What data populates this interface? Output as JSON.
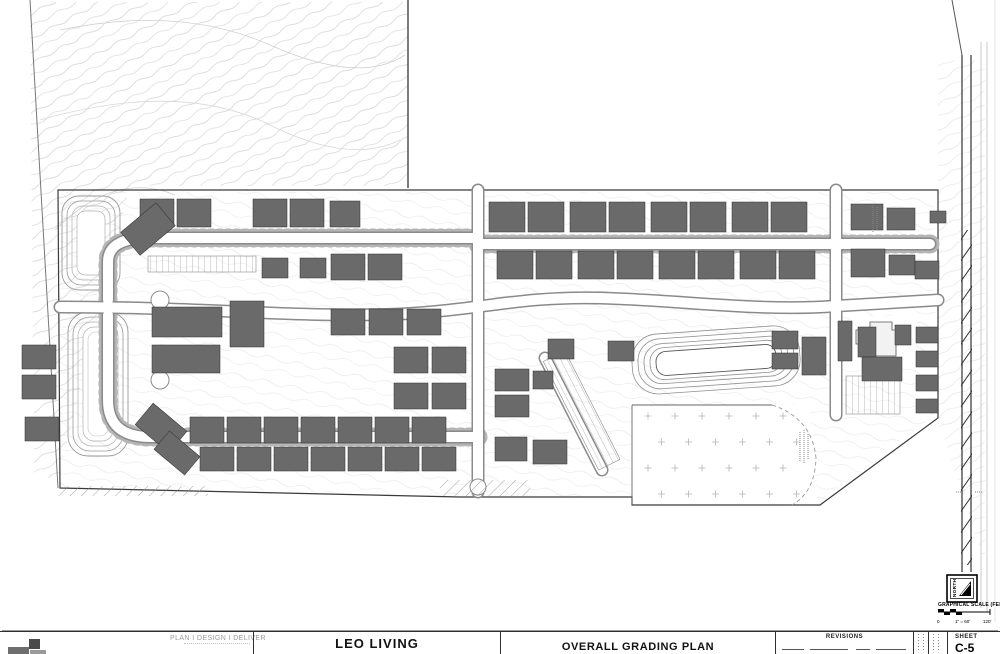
{
  "title_block": {
    "firm_tagline": "PLAN I DESIGN I DELIVER",
    "project_name": "LEO LIVING",
    "sheet_title": "OVERALL GRADING PLAN",
    "revisions_label": "REVISIONS",
    "sheet_label": "SHEET",
    "sheet_number": "C-5"
  },
  "map_furniture": {
    "north_label": "NORTH",
    "scale_title": "GRAPHICAL SCALE (FEET)",
    "scale_ticks": [
      "0",
      "1\" = 60'",
      "120'"
    ]
  },
  "colors": {
    "paper": "#ffffff",
    "line_dark": "#2f2f2f",
    "line_mid": "#8a8a8a",
    "line_light": "#cfcfcf",
    "contour": "#c9c9c9",
    "building_fill": "#6a6a6a",
    "building_stroke": "#2e2e2e",
    "text_gray": "#9a9a9a"
  },
  "site_plan": {
    "buildings": [
      [
        140,
        199,
        34,
        28
      ],
      [
        177,
        199,
        34,
        28
      ],
      [
        253,
        199,
        34,
        28
      ],
      [
        290,
        199,
        34,
        28
      ],
      [
        330,
        201,
        30,
        26
      ],
      [
        125,
        214,
        46,
        30,
        -40
      ],
      [
        262,
        258,
        26,
        20
      ],
      [
        300,
        258,
        26,
        20
      ],
      [
        152,
        307,
        70,
        30
      ],
      [
        230,
        301,
        34,
        46
      ],
      [
        152,
        345,
        68,
        28
      ],
      [
        331,
        254,
        34,
        26
      ],
      [
        368,
        254,
        34,
        26
      ],
      [
        331,
        309,
        34,
        26
      ],
      [
        369,
        309,
        34,
        26
      ],
      [
        407,
        309,
        34,
        26
      ],
      [
        394,
        347,
        34,
        26
      ],
      [
        432,
        347,
        34,
        26
      ],
      [
        394,
        383,
        34,
        26
      ],
      [
        432,
        383,
        34,
        26
      ],
      [
        190,
        417,
        34,
        26
      ],
      [
        227,
        417,
        34,
        26
      ],
      [
        264,
        417,
        34,
        26
      ],
      [
        301,
        417,
        34,
        26
      ],
      [
        338,
        417,
        34,
        26
      ],
      [
        375,
        417,
        34,
        26
      ],
      [
        412,
        417,
        34,
        26
      ],
      [
        200,
        447,
        34,
        24
      ],
      [
        237,
        447,
        34,
        24
      ],
      [
        274,
        447,
        34,
        24
      ],
      [
        311,
        447,
        34,
        24
      ],
      [
        348,
        447,
        34,
        24
      ],
      [
        385,
        447,
        34,
        24
      ],
      [
        422,
        447,
        34,
        24
      ],
      [
        139,
        414,
        44,
        28,
        40
      ],
      [
        157,
        441,
        40,
        24,
        40
      ],
      [
        22,
        345,
        34,
        24
      ],
      [
        22,
        375,
        34,
        24
      ],
      [
        25,
        417,
        34,
        24
      ],
      [
        489,
        202,
        36,
        30
      ],
      [
        528,
        202,
        36,
        30
      ],
      [
        570,
        202,
        36,
        30
      ],
      [
        609,
        202,
        36,
        30
      ],
      [
        651,
        202,
        36,
        30
      ],
      [
        690,
        202,
        36,
        30
      ],
      [
        732,
        202,
        36,
        30
      ],
      [
        771,
        202,
        36,
        30
      ],
      [
        497,
        251,
        36,
        28
      ],
      [
        536,
        251,
        36,
        28
      ],
      [
        578,
        251,
        36,
        28
      ],
      [
        617,
        251,
        36,
        28
      ],
      [
        659,
        251,
        36,
        28
      ],
      [
        698,
        251,
        36,
        28
      ],
      [
        740,
        251,
        36,
        28
      ],
      [
        779,
        251,
        36,
        28
      ],
      [
        851,
        204,
        32,
        26
      ],
      [
        887,
        208,
        28,
        22
      ],
      [
        851,
        249,
        34,
        28
      ],
      [
        889,
        255,
        26,
        20
      ],
      [
        915,
        261,
        24,
        18
      ],
      [
        930,
        211,
        16,
        12
      ],
      [
        495,
        369,
        34,
        22
      ],
      [
        495,
        395,
        34,
        22
      ],
      [
        533,
        371,
        20,
        18
      ],
      [
        548,
        339,
        26,
        20
      ],
      [
        608,
        341,
        26,
        20
      ],
      [
        495,
        437,
        32,
        24
      ],
      [
        533,
        440,
        34,
        24
      ],
      [
        772,
        331,
        26,
        18
      ],
      [
        772,
        353,
        26,
        16
      ],
      [
        802,
        337,
        24,
        38
      ],
      [
        858,
        327,
        18,
        30
      ],
      [
        895,
        325,
        16,
        20
      ],
      [
        862,
        357,
        40,
        24
      ],
      [
        916,
        327,
        22,
        16
      ],
      [
        916,
        351,
        22,
        16
      ],
      [
        916,
        375,
        22,
        16
      ],
      [
        916,
        399,
        22,
        14
      ],
      [
        838,
        321,
        14,
        40
      ]
    ],
    "tree_grid": {
      "x": 648,
      "y": 416,
      "cols": 6,
      "rows": 4,
      "dx": 27,
      "dy": 26,
      "size": 7
    }
  }
}
